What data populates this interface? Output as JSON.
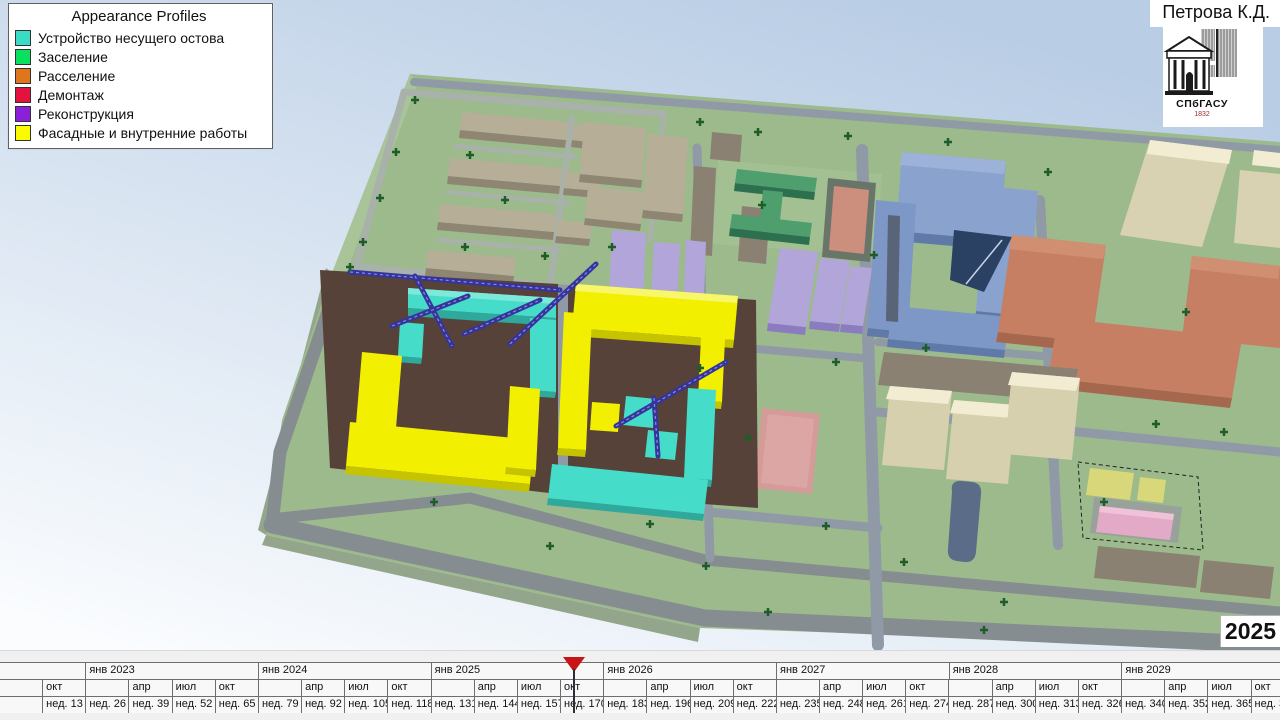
{
  "legend": {
    "title": "Appearance Profiles",
    "items": [
      {
        "label": "Устройство несущего остова",
        "color": "#3adcc6"
      },
      {
        "label": "Заселение",
        "color": "#0be05e"
      },
      {
        "label": "Расселение",
        "color": "#e0761c"
      },
      {
        "label": "Демонтаж",
        "color": "#e51240"
      },
      {
        "label": "Реконструкция",
        "color": "#8c20d8"
      },
      {
        "label": "Фасадные и внутренние работы",
        "color": "#fbfb00"
      }
    ]
  },
  "header": {
    "author": "Петрова К.Д."
  },
  "logo": {
    "abbr": "СПбГАСУ",
    "year": "1832"
  },
  "status": {
    "current_year": "2025"
  },
  "timeline": {
    "quarter_width_px": 43.17,
    "playhead_x_px": 574,
    "playhead_color": "#c81414",
    "years": [
      "янв 2023",
      "янв 2024",
      "янв 2025",
      "янв 2026",
      "янв 2027",
      "янв 2028",
      "янв 2029"
    ],
    "quarters": [
      "",
      "окт",
      "",
      "апр",
      "июл",
      "окт",
      "",
      "апр",
      "июл",
      "окт",
      "",
      "апр",
      "июл",
      "окт",
      "",
      "апр",
      "июл",
      "окт",
      "",
      "апр",
      "июл",
      "окт",
      "",
      "апр",
      "июл",
      "окт",
      "",
      "апр",
      "июл",
      "окт"
    ],
    "weeks": [
      "",
      "нед. 13",
      "нед. 26",
      "нед. 39",
      "нед. 52",
      "нед. 65",
      "нед. 79",
      "нед. 92",
      "нед. 105",
      "нед. 118",
      "нед. 131",
      "нед. 144",
      "нед. 157",
      "нед. 170",
      "нед. 183",
      "нед. 196",
      "нед. 209",
      "нед. 222",
      "нед. 235",
      "нед. 248",
      "нед. 261",
      "нед. 274",
      "нед. 287",
      "нед. 300",
      "нед. 313",
      "нед. 326",
      "нед. 340",
      "нед. 352",
      "нед. 365",
      "нед. 378"
    ]
  },
  "scene": {
    "colors": {
      "sky-top": "#b9cde5",
      "sky-bottom": "#fafcfe",
      "grass": "#9cba8c",
      "grass-light": "#a8c498",
      "grass-side": "#93a68b",
      "road-dark": "#868d90",
      "road-light": "#a9b2aa",
      "road-blue": "#8f9aa6",
      "dirt": "#564239",
      "bldg-tan-top": "#b6ae97",
      "bldg-tan-side": "#8e8672",
      "bldg-green-top": "#4e9e6e",
      "bldg-green-side": "#2d7050",
      "field-salmon": "#cc8f7e",
      "field-frame": "#6a756a",
      "bldg-purple-top": "#b2a5da",
      "bldg-purple-side": "#8b7cc0",
      "bldg-blue-top": "#8aa2ce",
      "bldg-blue-mid": "#7d97c6",
      "bldg-blue-side": "#5f7aa8",
      "glass-navy": "#2b4164",
      "bldg-cream-top": "#f2ecd2",
      "bldg-cream-side": "#d6d0ae",
      "bldg-khaki": "#d9d2b2",
      "bldg-terra-top": "#c67f62",
      "bldg-terra-side": "#a5684e",
      "bldg-gray": "#8a8173",
      "field-pink": "#d59b99",
      "pond": "#5a6c88",
      "zone-yellow": "#d8d87a",
      "zone-pink": "#e3aac7",
      "hl-cyan": "#45ddca",
      "hl-cyan-side": "#2fa99b",
      "hl-yellow": "#f2ef00",
      "hl-yellow-side": "#c6c400",
      "crane": "#34349c",
      "tree": "#1e5c28"
    }
  }
}
